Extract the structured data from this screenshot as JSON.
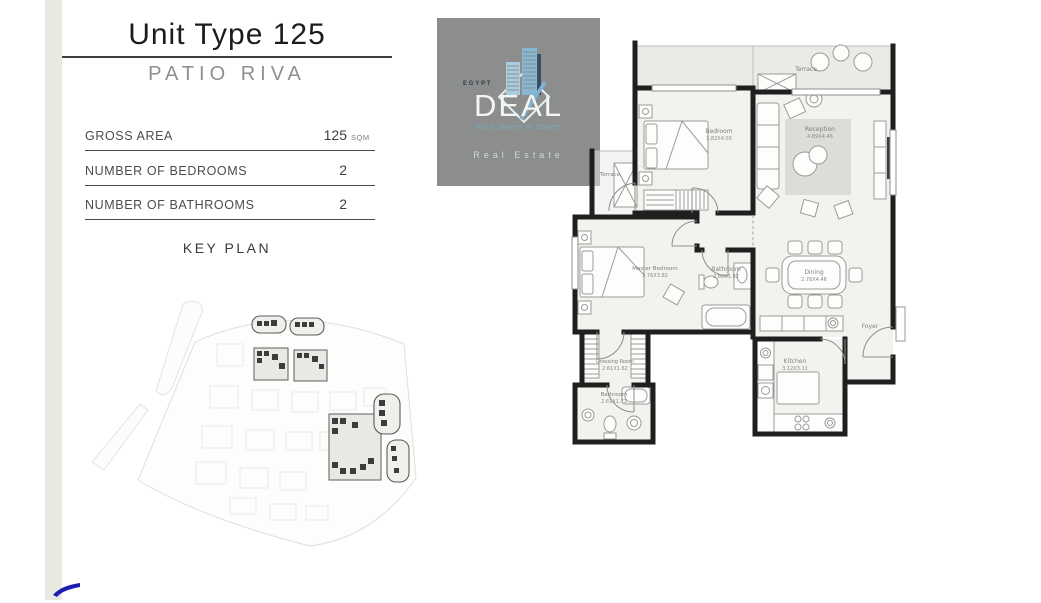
{
  "unit": {
    "title": "Unit Type 125",
    "project": "PATIO RIVA"
  },
  "specs": [
    {
      "label": "GROSS AREA",
      "value": "125",
      "unit": "SQM"
    },
    {
      "label": "NUMBER OF BEDROOMS",
      "value": "2",
      "unit": ""
    },
    {
      "label": "NUMBER OF BATHROOMS",
      "value": "2",
      "unit": ""
    }
  ],
  "key_plan": {
    "heading": "KEY PLAN"
  },
  "logo": {
    "country": "EGYPT",
    "brand": "DEAL",
    "tagline": "From Owner to Owner",
    "footer": "Real Estate"
  },
  "floor_plan": {
    "rooms": {
      "bedroom": {
        "name": "Bedroom",
        "dims": "3.82X4.03"
      },
      "reception": {
        "name": "Reception",
        "dims": "4.89X4.46"
      },
      "master_bedroom": {
        "name": "Master Bedroom",
        "dims": "3.76X3.82"
      },
      "bathroom_1": {
        "name": "Bathroom",
        "dims": "2.60X1.92"
      },
      "dining": {
        "name": "Dining",
        "dims": "2.76X4.46"
      },
      "dressing_room": {
        "name": "Dressing Room",
        "dims": "2.61X1.62"
      },
      "bathroom_2": {
        "name": "Bathroom",
        "dims": "2.61X1.71"
      },
      "kitchen": {
        "name": "Kitchen",
        "dims": "3.12X3.11"
      },
      "foyer": {
        "name": "Foyer"
      },
      "terrace_top": {
        "name": "Terrace"
      },
      "terrace_side": {
        "name": "Terrace"
      }
    }
  },
  "colors": {
    "accent_bar": "#e8eae1",
    "logo_background": "#8b8e8c",
    "logo_blue": "#7fb3d5",
    "wall": "#1f1f1f",
    "corner_mark_blue": "#1d1db0"
  }
}
